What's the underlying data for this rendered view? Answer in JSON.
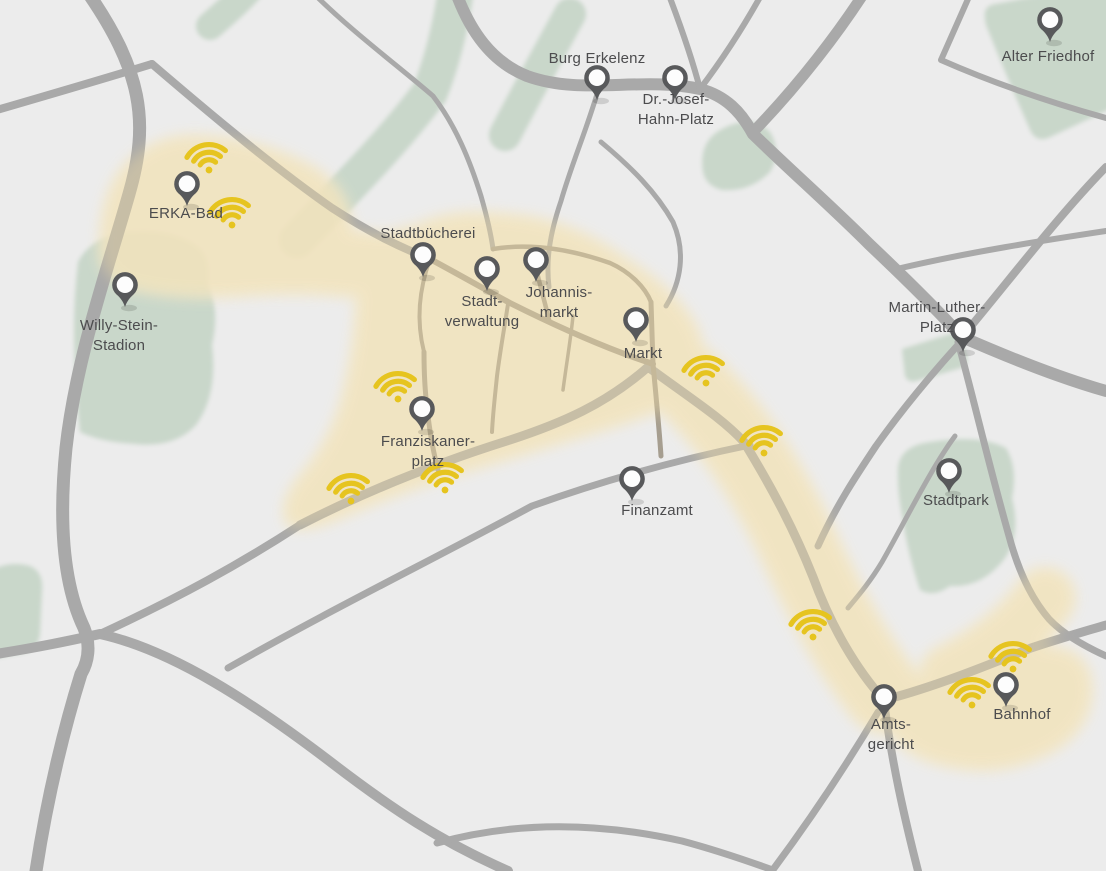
{
  "map": {
    "description": "City map of Erkelenz showing public WiFi hotspot coverage",
    "label_line_height": 20,
    "colors": {
      "background": "#ececec",
      "road": "#a9a9a9",
      "road_inner": "#a69e90",
      "park": "#c9d7ca",
      "zone": "#f8efd8",
      "zone_overlay": "#ecd9a4",
      "wifi_icon": "#e6c41f",
      "pin": "#58595b",
      "pin_hole": "#fdfdfd",
      "label": "#4c4c4e"
    },
    "places": [
      {
        "id": "burg-erkelenz",
        "label_lines": [
          "Burg Erkelenz"
        ],
        "pin": {
          "x": 597,
          "y": 100
        },
        "label": {
          "x": 597,
          "y": 63
        }
      },
      {
        "id": "dr-josef-hahn-platz",
        "label_lines": [
          "Dr.-Josef-",
          "Hahn-Platz"
        ],
        "pin": {
          "x": 675,
          "y": 100
        },
        "label": {
          "x": 676,
          "y": 104
        }
      },
      {
        "id": "alter-friedhof",
        "label_lines": [
          "Alter Friedhof"
        ],
        "pin": {
          "x": 1050,
          "y": 42
        },
        "label": {
          "x": 1048,
          "y": 61
        }
      },
      {
        "id": "erka-bad",
        "label_lines": [
          "ERKA-Bad"
        ],
        "pin": {
          "x": 187,
          "y": 206
        },
        "label": {
          "x": 186,
          "y": 218
        }
      },
      {
        "id": "willy-stein-stadion",
        "label_lines": [
          "Willy-Stein-",
          "Stadion"
        ],
        "pin": {
          "x": 125,
          "y": 307
        },
        "label": {
          "x": 119,
          "y": 330
        }
      },
      {
        "id": "stadtbuecherei",
        "label_lines": [
          "Stadtbücherei"
        ],
        "pin": {
          "x": 423,
          "y": 277
        },
        "label": {
          "x": 428,
          "y": 238
        }
      },
      {
        "id": "stadtverwaltung",
        "label_lines": [
          "Stadt-",
          "verwaltung"
        ],
        "pin": {
          "x": 487,
          "y": 291
        },
        "label": {
          "x": 482,
          "y": 306
        }
      },
      {
        "id": "johannismarkt",
        "label_lines": [
          "Johannis-",
          "markt"
        ],
        "pin": {
          "x": 536,
          "y": 282
        },
        "label": {
          "x": 559,
          "y": 297
        }
      },
      {
        "id": "markt",
        "label_lines": [
          "Markt"
        ],
        "pin": {
          "x": 636,
          "y": 342
        },
        "label": {
          "x": 643,
          "y": 358
        }
      },
      {
        "id": "martin-luther-platz",
        "label_lines": [
          "Martin-Luther-",
          "Platz"
        ],
        "pin": {
          "x": 963,
          "y": 352
        },
        "label": {
          "x": 937,
          "y": 312
        }
      },
      {
        "id": "franziskanerplatz",
        "label_lines": [
          "Franziskaner-",
          "platz"
        ],
        "pin": {
          "x": 422,
          "y": 431
        },
        "label": {
          "x": 428,
          "y": 446
        }
      },
      {
        "id": "finanzamt",
        "label_lines": [
          "Finanzamt"
        ],
        "pin": {
          "x": 632,
          "y": 501
        },
        "label": {
          "x": 657,
          "y": 515
        }
      },
      {
        "id": "stadtpark",
        "label_lines": [
          "Stadtpark"
        ],
        "pin": {
          "x": 949,
          "y": 493
        },
        "label": {
          "x": 956,
          "y": 505
        }
      },
      {
        "id": "amtsgericht",
        "label_lines": [
          "Amts-",
          "gericht"
        ],
        "pin": {
          "x": 884,
          "y": 719
        },
        "label": {
          "x": 891,
          "y": 729
        }
      },
      {
        "id": "bahnhof",
        "label_lines": [
          "Bahnhof"
        ],
        "pin": {
          "x": 1006,
          "y": 707
        },
        "label": {
          "x": 1022,
          "y": 719
        }
      }
    ],
    "hotspots": [
      {
        "x": 209,
        "y": 158
      },
      {
        "x": 232,
        "y": 213
      },
      {
        "x": 398,
        "y": 387
      },
      {
        "x": 351,
        "y": 489
      },
      {
        "x": 445,
        "y": 478
      },
      {
        "x": 706,
        "y": 371
      },
      {
        "x": 764,
        "y": 441
      },
      {
        "x": 813,
        "y": 625
      },
      {
        "x": 1013,
        "y": 657
      },
      {
        "x": 972,
        "y": 693
      }
    ]
  }
}
